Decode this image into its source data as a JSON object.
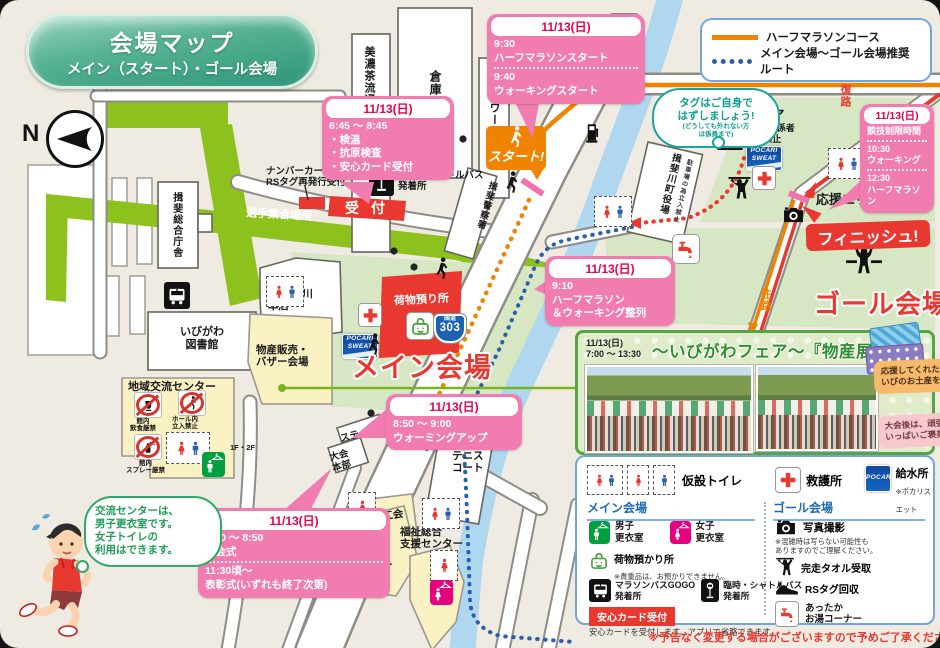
{
  "title": {
    "line1": "会場マップ",
    "line2": "メイン（スタート）・ゴール会場"
  },
  "compass": "N",
  "route_legend": {
    "half": "ハーフマラソンコース",
    "recommended": "メイン会場～ゴール会場推奨ルート"
  },
  "route_sign": {
    "name": "国道",
    "number": "303"
  },
  "banners": {
    "start": "スタート!",
    "finish": "フィニッシュ!",
    "reception": "受付",
    "main_venue": "メイン会場",
    "goal_venue": "ゴール会場",
    "baggage_map": "荷物預り所",
    "assembly": "選手集合場所",
    "cheer_area": "応援エリア",
    "outbound": "往路",
    "return": "復路"
  },
  "players_area": {
    "title": "選手エリア",
    "note1": "※ランナー・関係者",
    "note2": "以外立入禁止"
  },
  "pocari": {
    "line1": "POCARI",
    "line2": "SWEAT"
  },
  "callouts": {
    "checkin": {
      "date": "11/13(日)",
      "time": "6:45 ～ 8:45",
      "item1": "・検温",
      "item2": "・抗原検査",
      "item3": "・安心カード受付"
    },
    "start_times": {
      "date": "11/13(日)",
      "time1": "9:30",
      "event1": "ハーフマラソンスタート",
      "time2": "9:40",
      "event2": "ウォーキングスタート"
    },
    "lineup": {
      "date": "11/13(日)",
      "time1": "9:10",
      "event1": "ハーフマラソン",
      "event1b": "＆ウォーキング整列"
    },
    "warmup": {
      "date": "11/13(日)",
      "time1": "8:50 ～ 9:00",
      "event1": "ウォーミングアップ"
    },
    "ceremony": {
      "date": "11/13(日)",
      "time1": "8:20 ～ 8:50",
      "event1": "開会式",
      "time2": "11:30頃～",
      "event2": "表彰式(いずれも終了次第)"
    },
    "limit": {
      "date": "11/13(日)",
      "heading": "競技制限時間",
      "time1": "10:30",
      "event1": "ウォーキング",
      "time2": "12:30",
      "event2": "ハーフマラソン"
    }
  },
  "bubbles": {
    "tag": {
      "line1": "タグはご自身で",
      "line2": "はずしましょう!",
      "note1": "(どうしても外れない方",
      "note2": "は係員まで)"
    },
    "changing": {
      "line1": "交流センターは、",
      "line2": "男子更衣室です。",
      "line3": "女子トイレの",
      "line4": "利用はできます。"
    }
  },
  "buildings": {
    "minocha": "美濃茶流通センター",
    "soko": "倉庫",
    "hellowork": "ハローワーク",
    "police": "揖斐警察署",
    "chosha": "揖斐総合庁舎",
    "library1": "いびがわ",
    "library2": "図書館",
    "ja1": "JAいび川",
    "ja2": "本店",
    "community": "地域交流センター",
    "bussan1": "物産販売・",
    "bussan2": "バザー会場",
    "stage": "ステージ",
    "hq1": "大会",
    "hq2": "本部",
    "tennis1": "テニス",
    "tennis2": "コート",
    "shokokai": "商工会",
    "hoken1": "保健",
    "hoken2": "センター",
    "fukushi1": "福祉総合",
    "fukushi2": "支援センター",
    "yakuba": "揖斐川町役場",
    "yakuba_note": "駐車場の為立入禁止",
    "kasugawa": "粕川",
    "numbercard1": "ナンバーカード",
    "numbercard2": "RSタグ再発行受付",
    "shuttle1": "臨時・シャトルバス",
    "shuttle2": "発着所"
  },
  "community_rules": {
    "r1a": "館内",
    "r1b": "飲食厳禁",
    "r2a": "ホール内",
    "r2b": "立入禁止",
    "r3a": "館内",
    "r3b": "スプレー厳禁",
    "floors": "1F・2F"
  },
  "fair": {
    "date": "11/13(日)",
    "time": "7:00 ～ 13:30",
    "title": "～いびがわフェア～『物産展』",
    "note1a": "応援してくれた家族や友達に",
    "note1b": "いびのお土産を!",
    "note2a": "大会後は、頑張った自分に",
    "note2b": "いっぱいご褒美を"
  },
  "legend_panel": {
    "toilet": "仮設トイレ",
    "aid": "救護所",
    "water": "給水所",
    "water_note": "※ポカリスエット",
    "main_heading": "メイン会場",
    "mens1": "男子",
    "mens2": "更衣室",
    "womens1": "女子",
    "womens2": "更衣室",
    "baggage": "荷物預かり所",
    "baggage_note": "※貴重品は、お預かりできません。",
    "bus1a": "マラソンバスGOGO",
    "bus1b": "発着所",
    "bus2a": "臨時・シャトルバス",
    "bus2b": "発着所",
    "card": "安心カード受付",
    "card_note": "安心カードを受付します。アプリで省略できます。",
    "goal_heading": "ゴール会場",
    "photo": "写真撮影",
    "photo_note1": "※混雑時は写らない可能性も",
    "photo_note2": "ありますのでご理解ください。",
    "towel": "完走タオル受取",
    "rstag": "RSタグ回収",
    "hot1": "あったか",
    "hot2": "お湯コーナー"
  },
  "footnote": "※予告なく変更する場合がございますので予めご了承ください。"
}
